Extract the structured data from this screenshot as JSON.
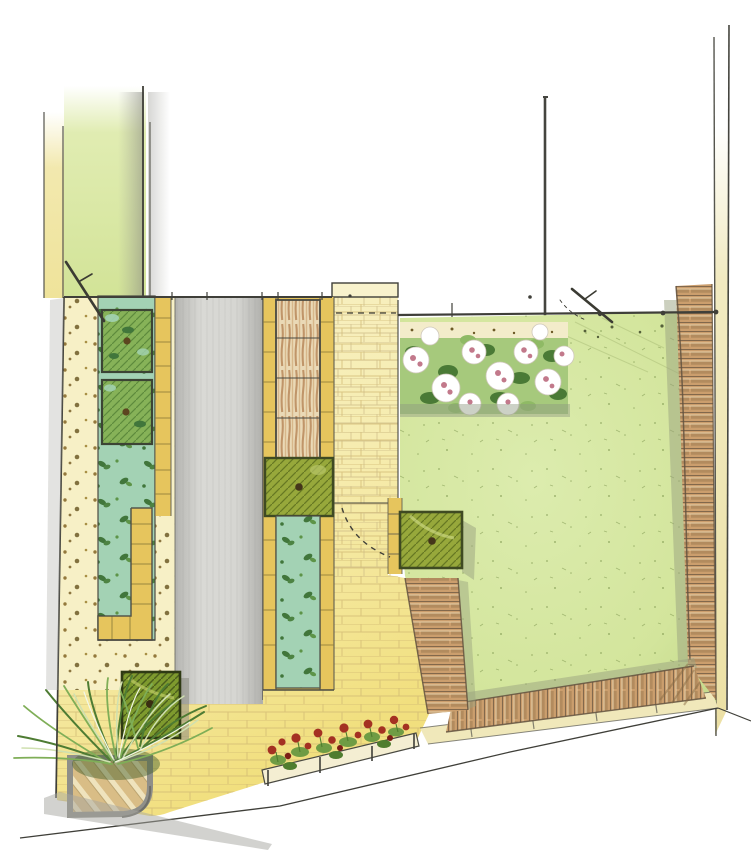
{
  "drawing": {
    "kind": "hand-rendered garden design plan, marker and pencil on white paper",
    "features": [
      "neighbouring-garden-strip",
      "boundary-lines",
      "gravel-strip",
      "clipped-box-squares",
      "teal-planting-beds",
      "yellow-brick-edging",
      "concrete-path",
      "willow-screen",
      "square-planters",
      "brick-path",
      "gate-swing-arc",
      "lawn",
      "rose-bed",
      "log-edging-hedge",
      "ornamental-grasses",
      "timber-deck",
      "red-bedding-row",
      "stone-kerb"
    ]
  },
  "palette": {
    "paper": "#ffffff",
    "ink": "#3f3f39",
    "pencil_shadow": "#9a9a94",
    "neighbour_green": "#dbe9a4",
    "neighbour_yellow": "#efe39a",
    "gravel": "#f7f0c6",
    "gravel_dot": "#8a6c2d",
    "teal_bed": "#a3d2b4",
    "leaf_dark": "#41763b",
    "leaf_mid": "#5d9448",
    "box_green": "#86b258",
    "box_hatch": "#4f7c33",
    "olive_planter": "#97a83b",
    "olive_dark": "#5a6c1d",
    "dark_square": "#7e9a2e",
    "edging_yellow": "#e6c55d",
    "edging_line": "#8a7a3a",
    "brick_cream": "#f8f2cc",
    "brick_line": "#c9b783",
    "paving_deep": "#f3e286",
    "gray_path": "#cfcfcb",
    "hedge_tan": "#cb9e6d",
    "hedge_line": "#63523f",
    "hedge_shadow": "#9aa27f",
    "outer_band": "#f0e8ba",
    "deck_plank": "#d9bd86",
    "deck_frame": "#8f8f89",
    "grass_dark": "#4e7c33",
    "grass_mid": "#7fae57",
    "grass_pale": "#cfe0b0",
    "lawn_light": "#dcecae",
    "lawn_edge": "#c8dd90",
    "bed_green": "#a6c97c",
    "flower_white": "#ffffff",
    "flower_pink": "#c2798b",
    "red_flower": "#a43122",
    "red_dark": "#7c1f15",
    "trough": "#f4eed2"
  }
}
